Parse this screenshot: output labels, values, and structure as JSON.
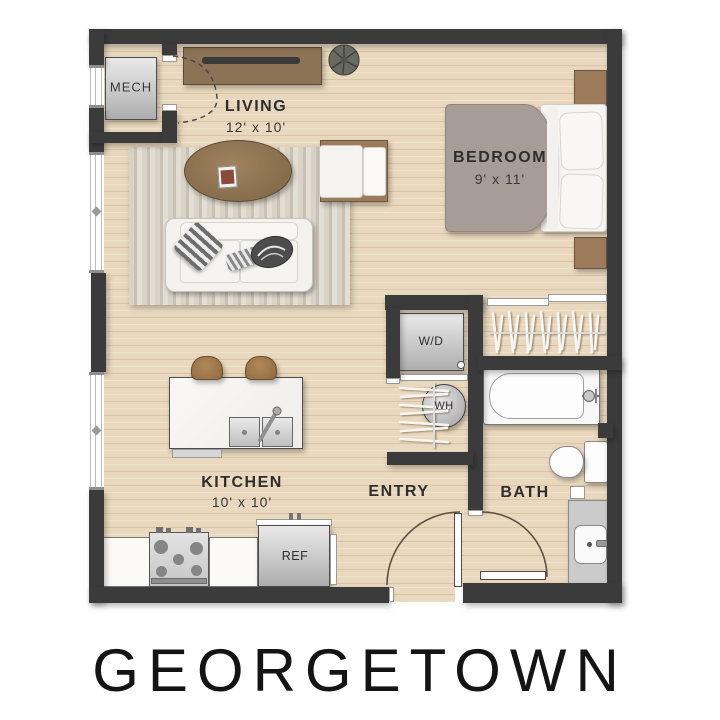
{
  "title": "GEORGETOWN",
  "rooms": {
    "mech": {
      "name": "MECH"
    },
    "living": {
      "name": "LIVING",
      "dims": "12' x 10'"
    },
    "bedroom": {
      "name": "BEDROOM",
      "dims": "9' x 11'"
    },
    "kitchen": {
      "name": "KITCHEN",
      "dims": "10' x 10'"
    },
    "entry": {
      "name": "ENTRY"
    },
    "bath": {
      "name": "BATH"
    }
  },
  "fixtures": {
    "washer_dryer": "W/D",
    "water_heater": "WH",
    "refrigerator": "REF"
  },
  "colors": {
    "wall": "#3b3b3b",
    "floor_wood": "#e9d8bd",
    "rug": "#d8d2c6",
    "wood_furniture": "#9c7b5b",
    "duvet_gray": "#a69d97",
    "appliance_gray": "#cfcfcf",
    "label_text": "#2e2e2e",
    "title_text": "#141414"
  }
}
